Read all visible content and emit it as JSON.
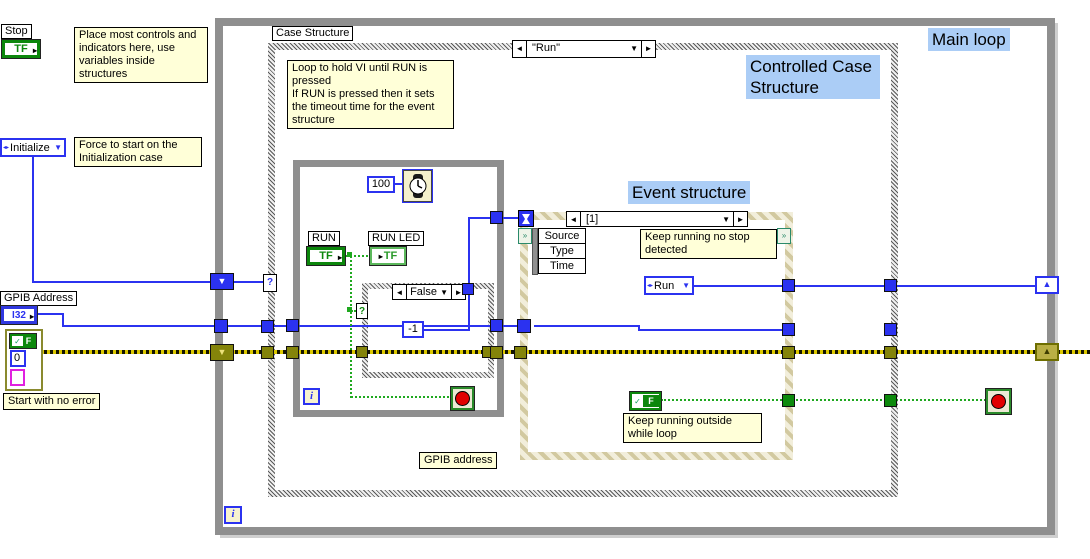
{
  "icons": {
    "dec_arrow": "◄",
    "inc_arrow": "►",
    "dropdown_arrow": "▼",
    "shift_down": "▼",
    "shift_up": "▲",
    "direction_arrow": "▸",
    "enum_symbol": "◂▸",
    "selector_question": "?",
    "checkmark": "✓",
    "event_reg": "»"
  },
  "left_panel": {
    "stop_label": "Stop",
    "stop_type": "TF",
    "place_comment": "Place most controls and indicators here, use variables inside structures",
    "initialize_label": "Initialize",
    "initialize_comment": "Force to start on the\nInitialization case",
    "gpib_label": "GPIB Address",
    "gpib_type": "I32",
    "error_status": "F",
    "error_code": "0",
    "error_comment": "Start with no error"
  },
  "main_loop": {
    "title": "Main loop",
    "iteration_label": "i"
  },
  "case_structure": {
    "name_label": "Case Structure",
    "selector_value": "\"Run\"",
    "title": "Controlled Case Structure",
    "loop_comment": "Loop to hold VI until RUN is pressed\nIf RUN is pressed then it sets the timeout time for the event structure",
    "gpib_local_label": "GPIB address"
  },
  "inner_loop": {
    "timeout_value": "100",
    "run_label": "RUN",
    "run_type": "TF",
    "run_led_label": "RUN LED",
    "run_led_type": "TF",
    "case_selector_value": "False",
    "timeout_constant": "-1",
    "iteration_label": "i"
  },
  "event_structure": {
    "title": "Event structure",
    "selector_value": "[1]",
    "event_fields": [
      "Source",
      "Type",
      "Time"
    ],
    "running_comment": "Keep running no stop\ndetected",
    "run_enum_value": "Run",
    "false_constant": "F",
    "outside_comment": "Keep running outside\nwhile loop"
  }
}
